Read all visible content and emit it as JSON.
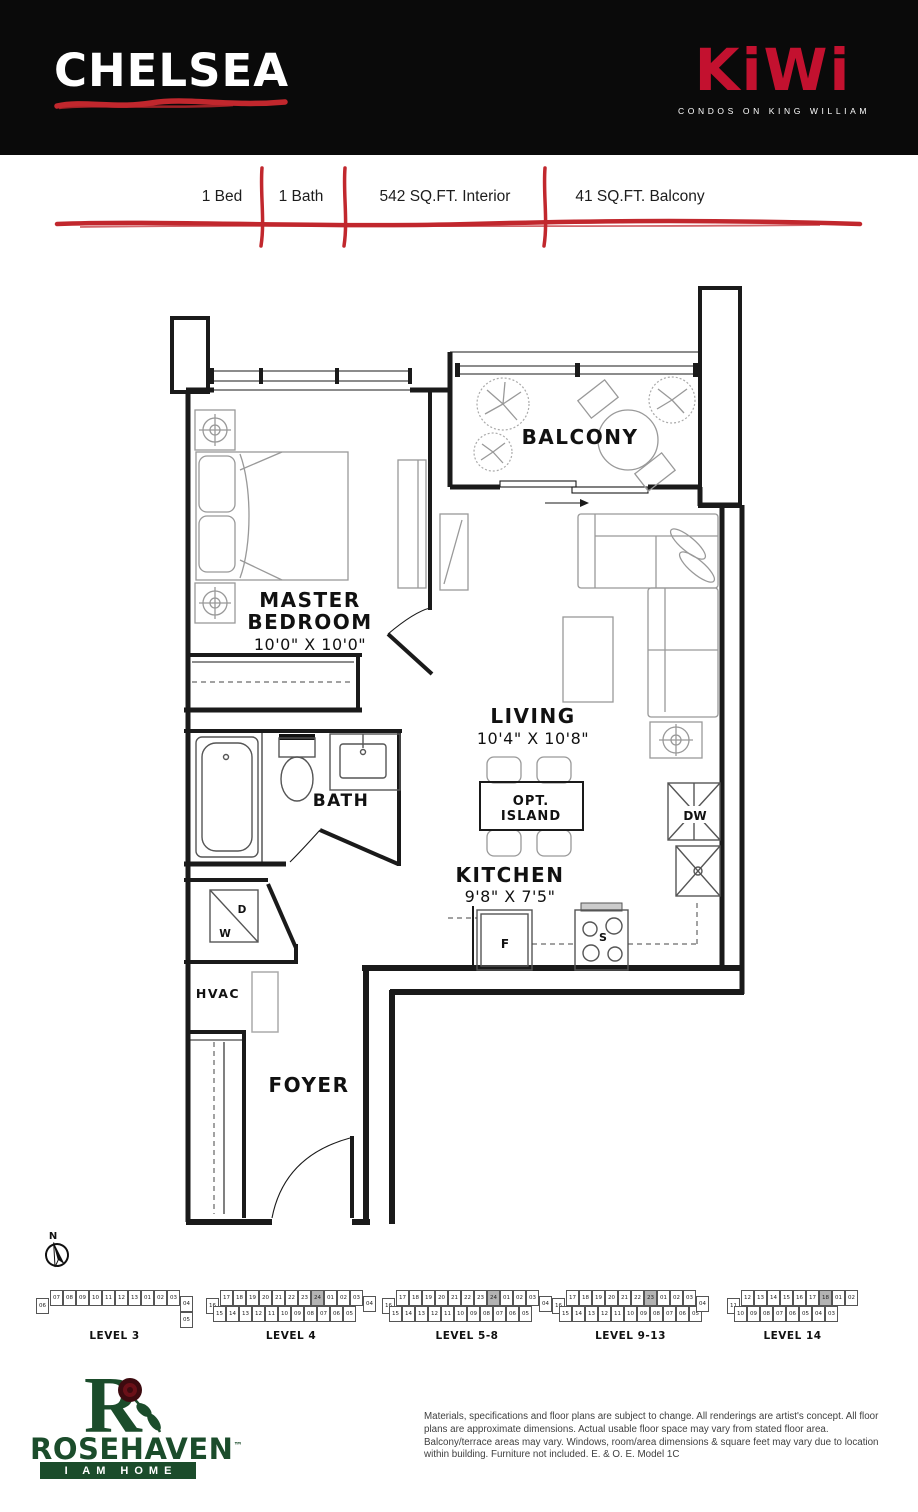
{
  "header": {
    "plan_name": "CHELSEA",
    "logo": {
      "brand": "KiWi",
      "tagline": "CONDOS ON KING WILLIAM"
    }
  },
  "specs": {
    "items": [
      "1 Bed",
      "1 Bath",
      "542 SQ.FT. Interior",
      "41 SQ.FT. Balcony"
    ]
  },
  "colors": {
    "brand_red": "#C3112F",
    "brush_red": "#C1272D",
    "builder_green": "#1B4C2B",
    "highlight_gray": "#B3B3B3"
  },
  "floorplan": {
    "rooms": {
      "master_bedroom": {
        "line1": "MASTER",
        "line2": "BEDROOM",
        "dims": "10'0\" X 10'0\""
      },
      "balcony": {
        "name": "BALCONY"
      },
      "living": {
        "name": "LIVING",
        "dims": "10'4\" X 10'8\""
      },
      "kitchen": {
        "name": "KITCHEN",
        "dims": "9'8\" X 7'5\""
      },
      "bath": {
        "name": "BATH"
      },
      "foyer": {
        "name": "FOYER"
      },
      "hvac": {
        "name": "HVAC"
      },
      "island": {
        "line1": "OPT.",
        "line2": "ISLAND"
      }
    },
    "appliances": {
      "dishwasher": "DW",
      "fridge": "F",
      "stove": "S",
      "dryer": "D",
      "washer": "W"
    },
    "compass_label": "N"
  },
  "keyplans": {
    "levels": [
      {
        "label": "LEVEL 3",
        "left_unit": "06",
        "highlight": "",
        "top_row": [
          "07",
          "08",
          "09",
          "10",
          "11",
          "12",
          "13",
          "01",
          "02",
          "03"
        ],
        "bottom_row": [],
        "right_col": [
          "04",
          "05"
        ]
      },
      {
        "label": "LEVEL 4",
        "left_unit": "16",
        "highlight": "24",
        "top_row": [
          "17",
          "18",
          "19",
          "20",
          "21",
          "22",
          "23",
          "24",
          "01",
          "02",
          "03"
        ],
        "bottom_row": [
          "15",
          "14",
          "13",
          "12",
          "11",
          "10",
          "09",
          "08",
          "07",
          "06",
          "05"
        ],
        "right_col": [
          "04"
        ]
      },
      {
        "label": "LEVEL 5-8",
        "left_unit": "16",
        "highlight": "24",
        "top_row": [
          "17",
          "18",
          "19",
          "20",
          "21",
          "22",
          "23",
          "24",
          "01",
          "02",
          "03"
        ],
        "bottom_row": [
          "15",
          "14",
          "13",
          "12",
          "11",
          "10",
          "09",
          "08",
          "07",
          "06",
          "05"
        ],
        "right_col": [
          "04"
        ]
      },
      {
        "label": "LEVEL 9-13",
        "left_unit": "16",
        "highlight": "23",
        "top_row": [
          "17",
          "18",
          "19",
          "20",
          "21",
          "22",
          "23",
          "01",
          "02",
          "03"
        ],
        "bottom_row": [
          "15",
          "14",
          "13",
          "12",
          "11",
          "10",
          "09",
          "08",
          "07",
          "06",
          "05"
        ],
        "right_col": [
          "04"
        ]
      },
      {
        "label": "LEVEL 14",
        "left_unit": "11",
        "highlight": "18",
        "top_row": [
          "12",
          "13",
          "14",
          "15",
          "16",
          "17",
          "18",
          "01",
          "02"
        ],
        "bottom_row": [
          "10",
          "09",
          "08",
          "07",
          "06",
          "05",
          "04",
          "03"
        ],
        "right_col": []
      }
    ]
  },
  "footer": {
    "builder": {
      "monogram": "R",
      "name": "ROSEHAVEN",
      "tm": "™",
      "tagline": "I AM HOME"
    },
    "disclaimer": "Materials, specifications and floor plans are subject to change. All renderings are artist's concept. All floor plans are approximate dimensions. Actual usable floor space may vary from stated floor area. Balcony/terrace areas may vary. Windows, room/area dimensions & square feet may vary due to location within building. Furniture not included. E. & O. E. Model 1C"
  }
}
